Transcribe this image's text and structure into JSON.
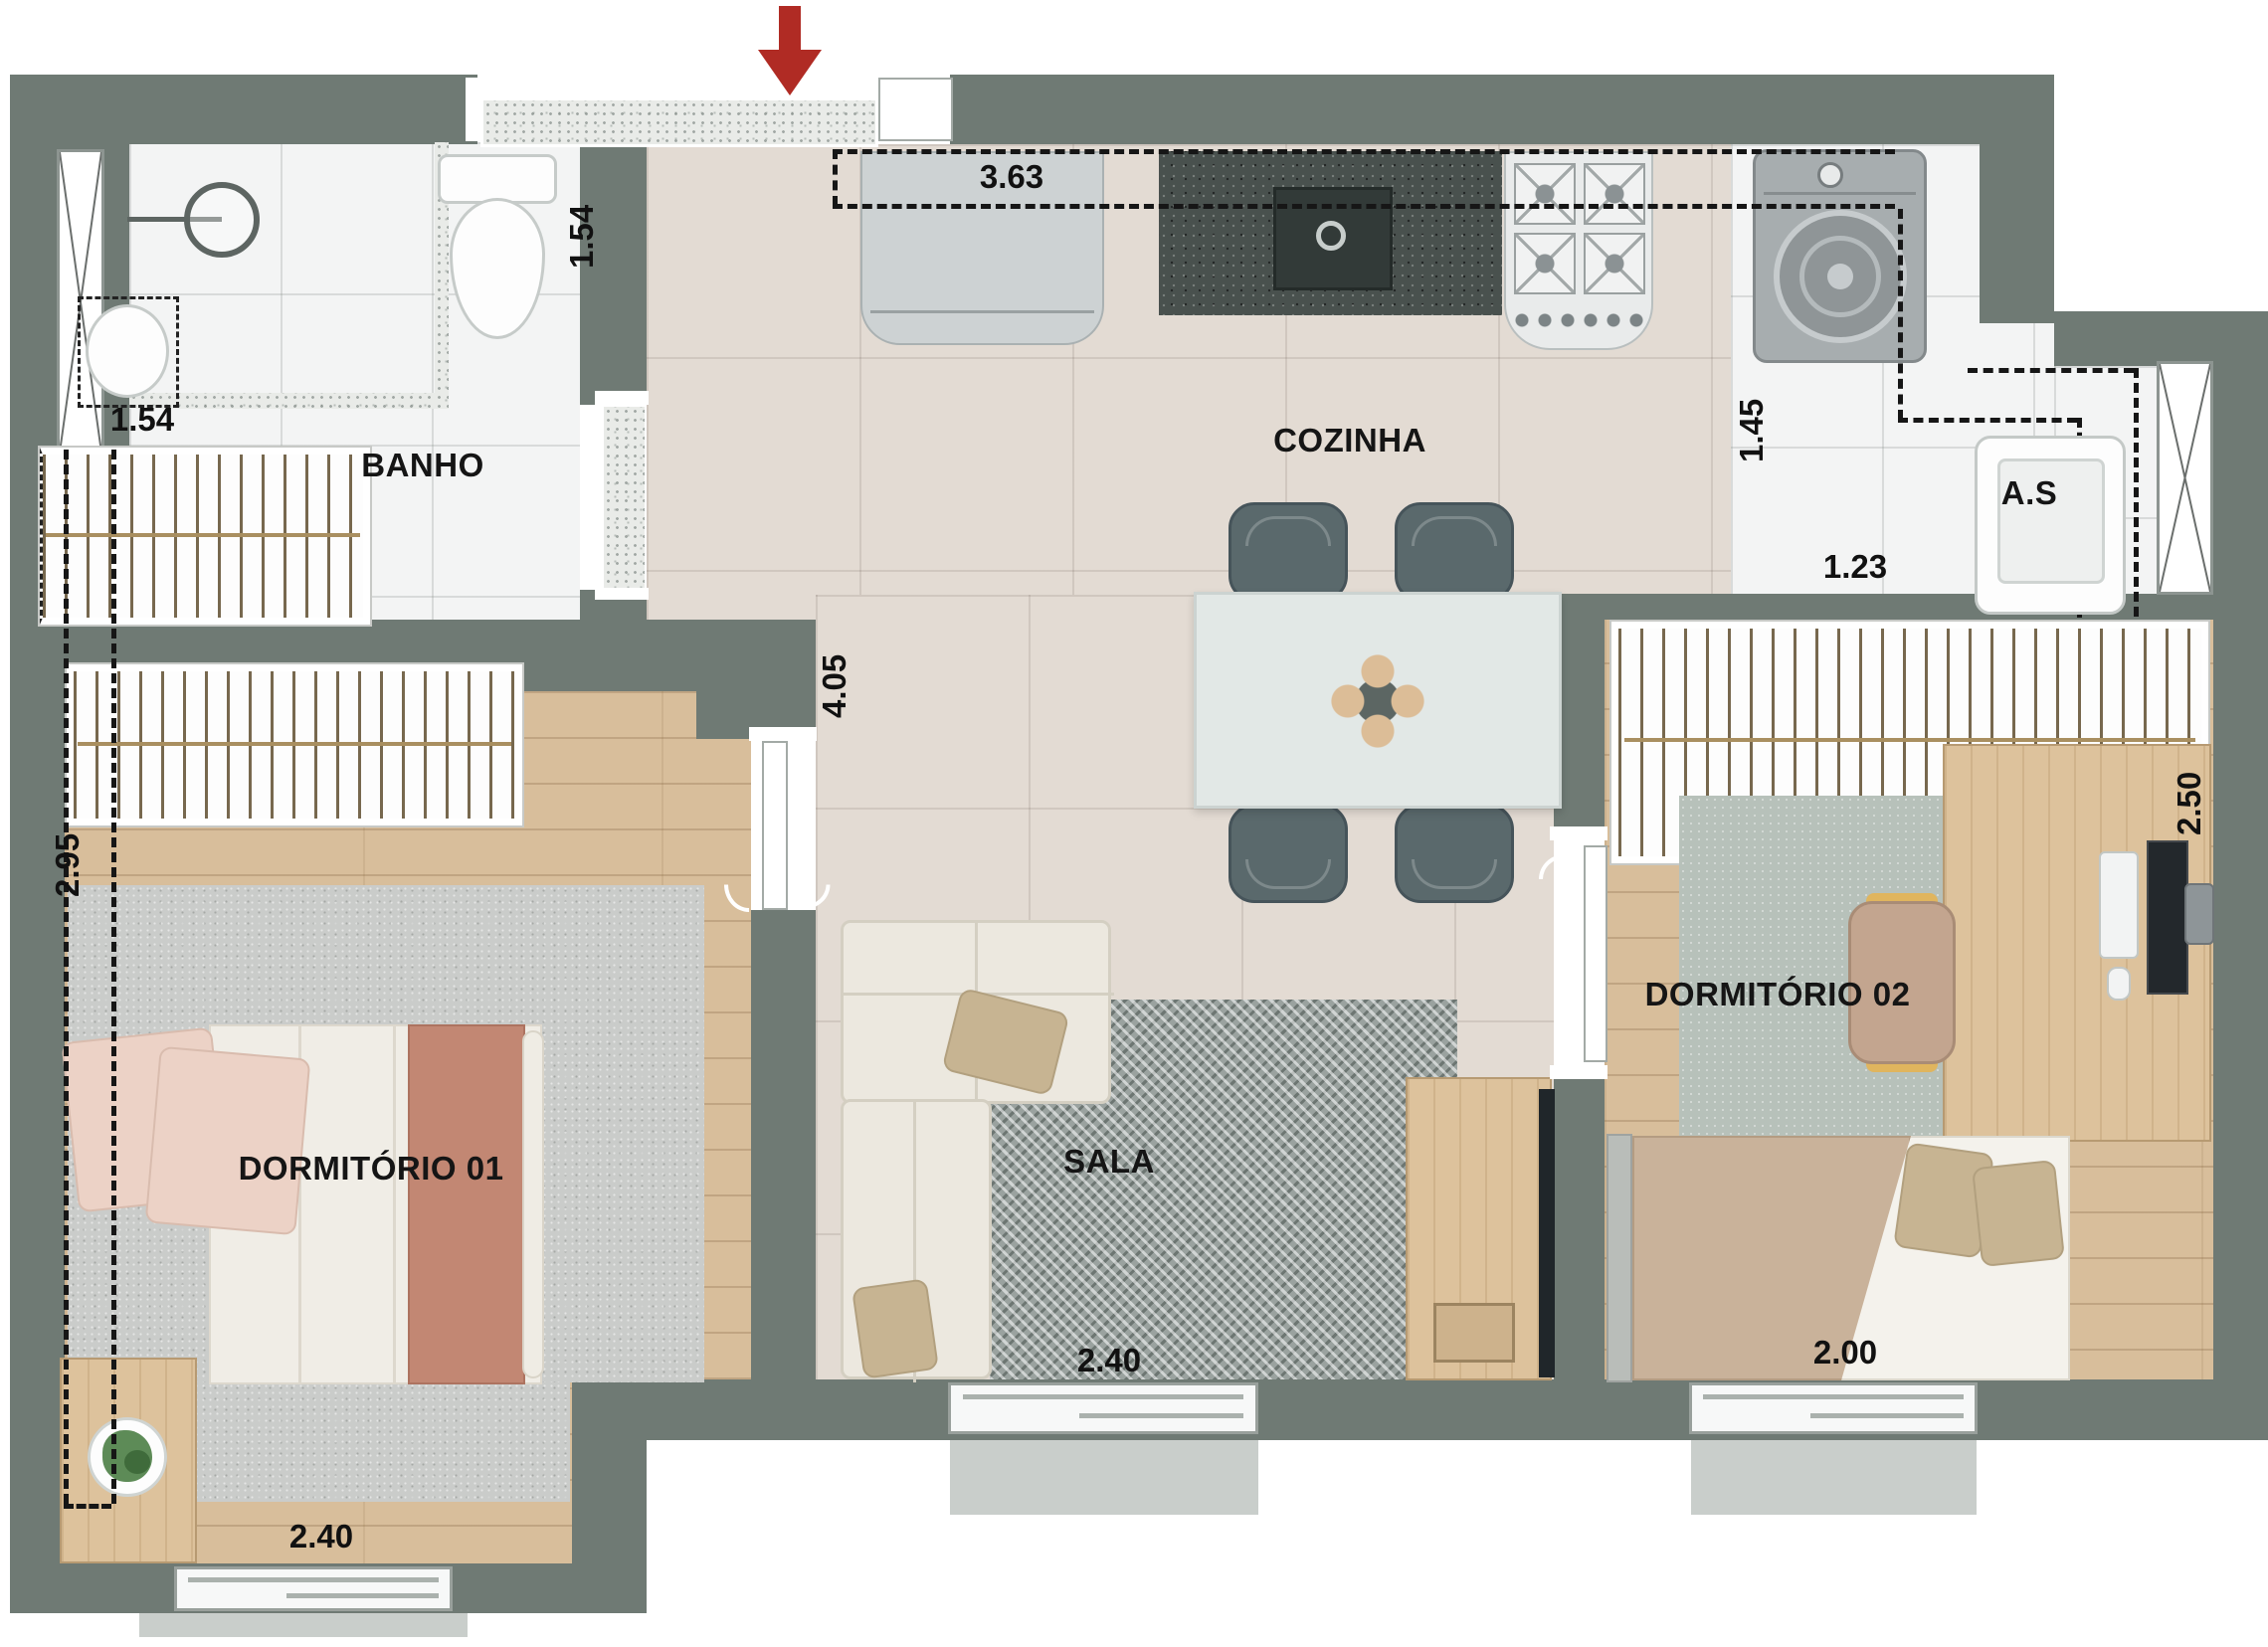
{
  "plan": {
    "rooms": {
      "banho": "BANHO",
      "cozinha": "COZINHA",
      "servico": "A.S",
      "sala": "SALA",
      "dorm1": "DORMITÓRIO 01",
      "dorm2": "DORMITÓRIO 02"
    },
    "dims": {
      "banho_width": "1.54",
      "banho_depth": "1.54",
      "cozinha_bancada": "3.63",
      "servico_depth": "1.45",
      "servico_width": "1.23",
      "circulacao": "4.05",
      "dorm1_depth": "2.95",
      "dorm1_width": "2.40",
      "sala_width": "2.40",
      "dorm2_depth": "2.50",
      "dorm2_width": "2.00"
    },
    "colors": {
      "wall": "#6f7a74",
      "tile": "#e3dbd3",
      "wood": "#d8be9b",
      "bath": "#f3f4f4",
      "rug": "#9aa29f",
      "arrow": "#b02b24"
    },
    "icons": {
      "entrance_arrow": "down-arrow"
    }
  }
}
